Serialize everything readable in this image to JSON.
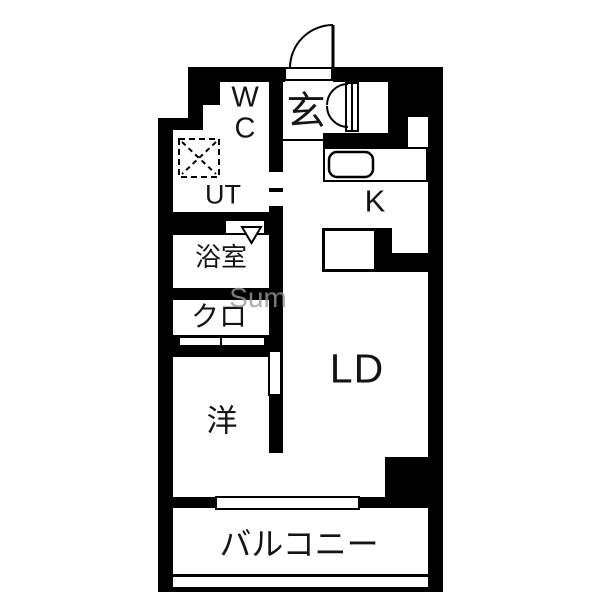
{
  "floorplan": {
    "rooms": {
      "wc": {
        "label": "W\nC"
      },
      "ut": {
        "label": "UT"
      },
      "genkan": {
        "label": "玄"
      },
      "kitchen": {
        "label": "K"
      },
      "bath": {
        "label": "浴室"
      },
      "closet": {
        "label": "クロ"
      },
      "western_room": {
        "label": "洋"
      },
      "living_dining": {
        "label": "LD"
      },
      "balcony": {
        "label": "バルコニー"
      }
    },
    "watermark": "Sum",
    "colors": {
      "wall": "#000000",
      "floor": "#ffffff",
      "text": "#141414",
      "watermark": "#9a9a9a"
    },
    "icons": {
      "entrance_door": "quarter-arc-door-swing",
      "genkan_closet": "double-door-arcs",
      "kitchen_sink": "rounded-rect-sink",
      "washer_space": "dashed-square-x",
      "bath_door": "triangle-marker"
    }
  }
}
